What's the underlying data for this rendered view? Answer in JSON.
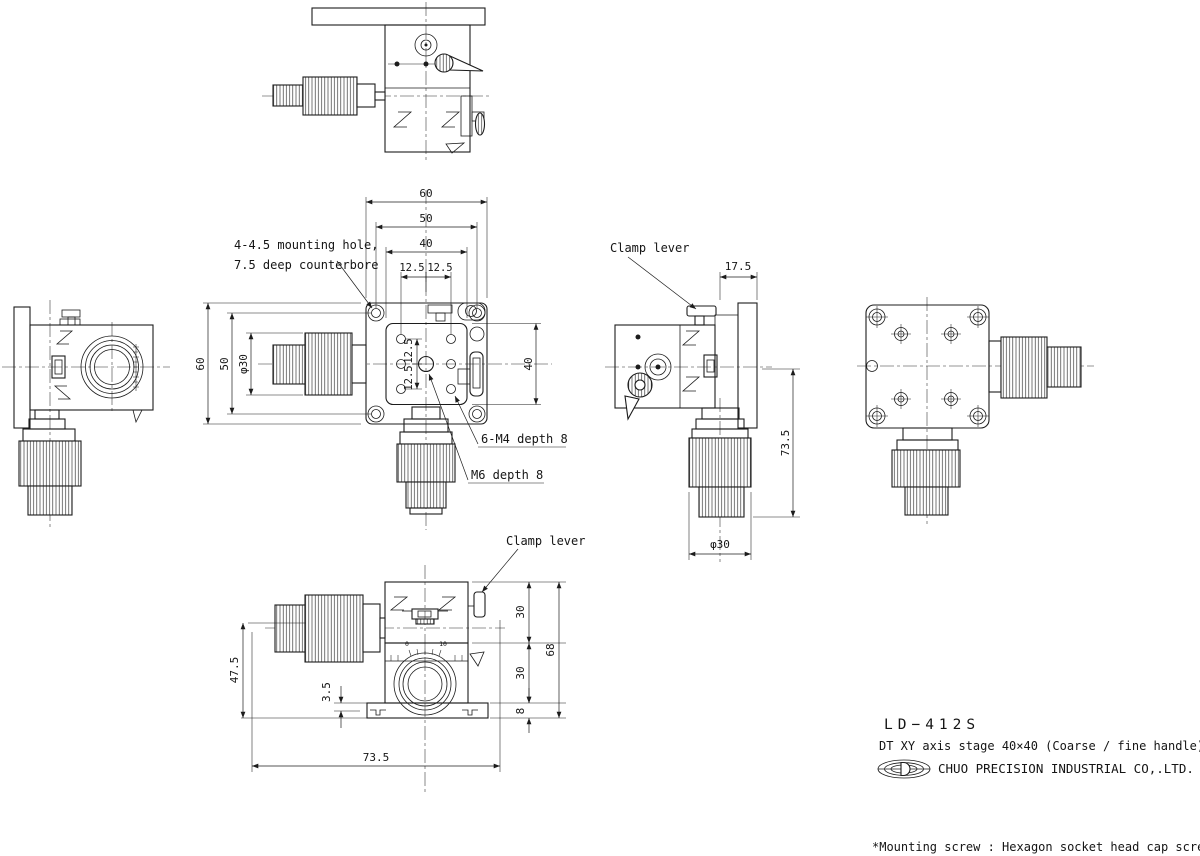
{
  "drawing": {
    "product_code": "LD−412S",
    "product_desc": "DT XY axis stage 40×40  (Coarse / fine handle)",
    "company_name": "CHUO PRECISION INDUSTRIAL CO,.LTD.",
    "footnote": "*Mounting screw : Hexagon socket head cap screw M4, 4 screws"
  },
  "labels": {
    "mounting_hole_line1": "4-4.5 mounting hole,",
    "mounting_hole_line2": "7.5 deep counterbore",
    "clamp_lever_side": "Clamp lever",
    "clamp_lever_front": "Clamp lever",
    "m4_holes": "6-M4 depth 8",
    "m6_hole": "M6 depth 8"
  },
  "dims": {
    "plan": {
      "w60": "60",
      "w50": "50",
      "w40": "40",
      "p125l": "12.5",
      "p125r": "12.5",
      "h60": "60",
      "h50": "50",
      "knob_dia": "φ30",
      "h40": "40",
      "pv125t": "12.5",
      "pv125b": "12.5"
    },
    "side": {
      "offset175": "17.5",
      "height735": "73.5",
      "knob_dia": "φ30"
    },
    "front": {
      "h30u": "30",
      "h30l": "30",
      "base8": "8",
      "total68": "68",
      "knob475": "47.5",
      "gap35": "3.5",
      "width735": "73.5",
      "dial0": "0",
      "dial10": "10"
    }
  }
}
